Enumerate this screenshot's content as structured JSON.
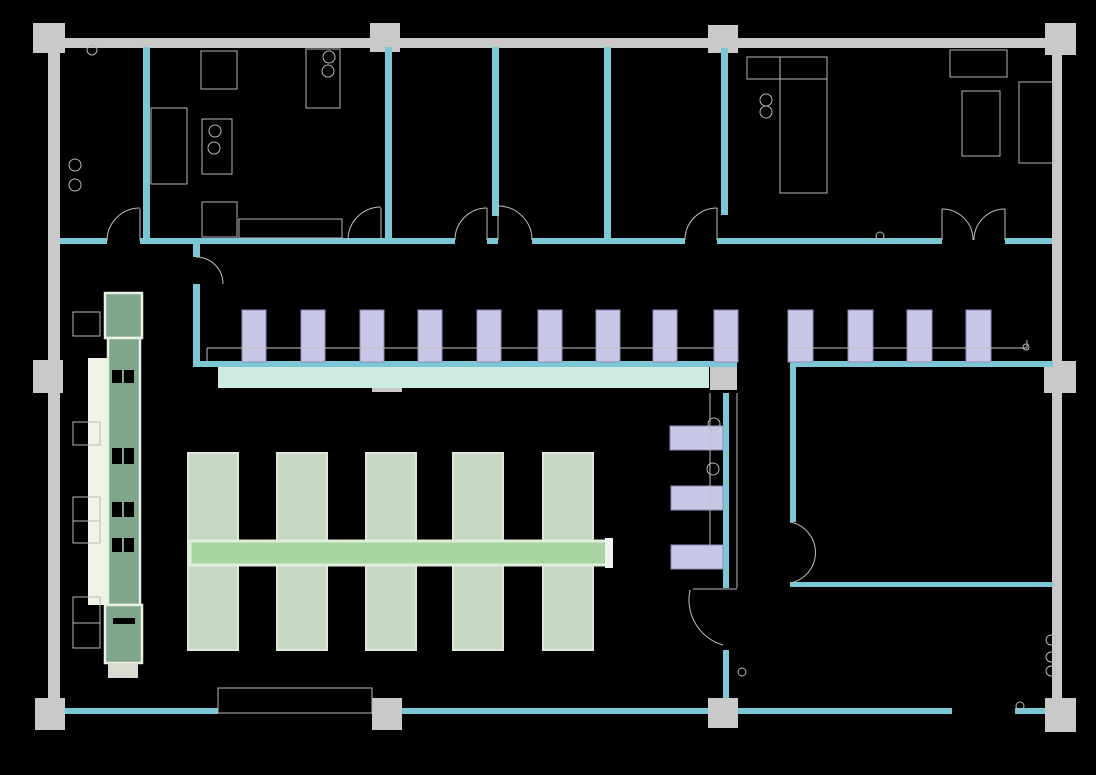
{
  "meta": {
    "description": "CAD floor plan of a cafeteria / canteen on black background",
    "canvas": {
      "width": 1096,
      "height": 775,
      "background": "#000000"
    }
  },
  "palette": {
    "structure_gray": "#c9c9c9",
    "wall_teal": "#7cc7d6",
    "counter_mint": "#cdebdf",
    "chair_lavender": "#c9c7e8",
    "chair_border": "#8f8db8",
    "table_sage": "#c6d8c2",
    "table_border": "#dfe9da",
    "bar_green": "#a8d5a2",
    "bar_border": "#e0efdb",
    "bar_cap": "#eef5ec",
    "buffet_green": "#7fa68b",
    "buffet_border": "#e9efe3",
    "buffet_strip": "#eef3e6",
    "buffet_cap": "#d9dad2",
    "outline_gray": "#b9b9b9",
    "line_gray": "#c0c0c0",
    "slot_black": "#000000"
  },
  "plan": {
    "layers": [
      {
        "name": "gray-structure",
        "kind": "rect",
        "fill": "#c9c9c9",
        "stroke": "none",
        "stroke_width": 0,
        "items": [
          [
            33,
            38,
            1042,
            10
          ],
          [
            48,
            47,
            12,
            662
          ],
          [
            1052,
            47,
            10,
            663
          ],
          [
            33,
            23,
            32,
            30
          ],
          [
            370,
            23,
            30,
            29
          ],
          [
            708,
            25,
            30,
            28
          ],
          [
            1045,
            23,
            31,
            32
          ],
          [
            33,
            360,
            30,
            33
          ],
          [
            372,
            368,
            30,
            24
          ],
          [
            710,
            365,
            27,
            25
          ],
          [
            1044,
            361,
            32,
            32
          ],
          [
            35,
            698,
            30,
            32
          ],
          [
            372,
            698,
            30,
            32
          ],
          [
            708,
            698,
            30,
            30
          ],
          [
            1045,
            698,
            31,
            34
          ]
        ]
      },
      {
        "name": "teal-wall",
        "kind": "rect",
        "fill": "#7cc7d6",
        "stroke": "none",
        "stroke_width": 0,
        "items": [
          [
            143,
            47,
            7,
            194
          ],
          [
            385,
            47,
            7,
            194
          ],
          [
            492,
            47,
            7,
            169
          ],
          [
            604,
            47,
            7,
            194
          ],
          [
            721,
            48,
            7,
            167
          ],
          [
            193,
            244,
            7,
            13
          ],
          [
            193,
            284,
            7,
            81
          ],
          [
            723,
            393,
            6,
            195
          ],
          [
            723,
            650,
            6,
            48
          ],
          [
            790,
            367,
            6,
            155
          ],
          [
            60,
            238,
            47,
            6
          ],
          [
            140,
            238,
            315,
            6
          ],
          [
            487,
            238,
            11,
            6
          ],
          [
            532,
            238,
            153,
            6
          ],
          [
            717,
            238,
            225,
            6
          ],
          [
            1005,
            238,
            47,
            6
          ],
          [
            193,
            361,
            544,
            6
          ],
          [
            790,
            361,
            263,
            6
          ],
          [
            790,
            582,
            263,
            5
          ],
          [
            65,
            708,
            153,
            6
          ],
          [
            402,
            708,
            306,
            6
          ],
          [
            738,
            708,
            214,
            6
          ],
          [
            1015,
            708,
            30,
            6
          ]
        ]
      },
      {
        "name": "service-counter",
        "kind": "rect",
        "fill": "#cdebdf",
        "stroke": "none",
        "stroke_width": 0,
        "items": [
          [
            218,
            367,
            491,
            21
          ]
        ]
      },
      {
        "name": "buffet-strip",
        "kind": "rect",
        "fill": "#eef3e6",
        "stroke": "none",
        "stroke_width": 0,
        "items": [
          [
            88,
            358,
            19,
            247
          ]
        ]
      },
      {
        "name": "buffet-block",
        "kind": "rect",
        "fill": "#7fa68b",
        "stroke": "#e9efe3",
        "stroke_width": 2.5,
        "items": [
          [
            105,
            293,
            37,
            45
          ],
          [
            108,
            338,
            32,
            267
          ],
          [
            105,
            605,
            37,
            58
          ]
        ]
      },
      {
        "name": "buffet-slot",
        "kind": "rect",
        "fill": "#000000",
        "stroke": "none",
        "stroke_width": 0,
        "items": [
          [
            112,
            370,
            10,
            13
          ],
          [
            124,
            370,
            10,
            13
          ],
          [
            112,
            448,
            10,
            16
          ],
          [
            124,
            448,
            10,
            16
          ],
          [
            112,
            502,
            10,
            15
          ],
          [
            124,
            502,
            10,
            15
          ],
          [
            112,
            538,
            10,
            14
          ],
          [
            124,
            538,
            10,
            14
          ],
          [
            113,
            618,
            22,
            6
          ]
        ]
      },
      {
        "name": "buffet-cap",
        "kind": "rect",
        "fill": "#d9dad2",
        "stroke": "none",
        "stroke_width": 0,
        "items": [
          [
            108,
            663,
            30,
            15
          ]
        ]
      },
      {
        "name": "bar-stool",
        "kind": "rect",
        "fill": "#c9c7e8",
        "stroke": "#8f8db8",
        "stroke_width": 1,
        "items": [
          [
            242,
            310,
            24,
            52
          ],
          [
            301,
            310,
            24,
            52
          ],
          [
            360,
            310,
            24,
            52
          ],
          [
            418,
            310,
            24,
            52
          ],
          [
            477,
            310,
            24,
            52
          ],
          [
            538,
            310,
            24,
            52
          ],
          [
            596,
            310,
            24,
            52
          ],
          [
            653,
            310,
            24,
            52
          ],
          [
            714,
            310,
            24,
            52
          ],
          [
            788,
            310,
            25,
            52
          ],
          [
            848,
            310,
            25,
            52
          ],
          [
            907,
            310,
            25,
            52
          ],
          [
            966,
            310,
            25,
            52
          ],
          [
            670,
            426,
            53,
            24
          ],
          [
            671,
            486,
            52,
            24
          ],
          [
            671,
            545,
            52,
            24
          ]
        ]
      },
      {
        "name": "dining-table",
        "kind": "rect",
        "fill": "#c6d8c2",
        "stroke": "#dfe9da",
        "stroke_width": 2,
        "items": [
          [
            188,
            453,
            50,
            197
          ],
          [
            277,
            453,
            50,
            197
          ],
          [
            366,
            453,
            50,
            197
          ],
          [
            453,
            453,
            50,
            197
          ],
          [
            543,
            453,
            50,
            197
          ]
        ]
      },
      {
        "name": "serving-bar",
        "kind": "rect",
        "fill": "#a8d5a2",
        "stroke": "#e0efdb",
        "stroke_width": 3,
        "items": [
          [
            190,
            541,
            420,
            24
          ]
        ]
      },
      {
        "name": "serving-bar-cap",
        "kind": "rect",
        "fill": "#eef5ec",
        "stroke": "none",
        "stroke_width": 0,
        "items": [
          [
            605,
            538,
            8,
            30
          ]
        ]
      },
      {
        "name": "fixture-outline",
        "kind": "rect",
        "fill": "none",
        "stroke": "#b9b9b9",
        "stroke_width": 1,
        "items": [
          [
            73,
            312,
            27,
            24
          ],
          [
            73,
            422,
            27,
            23
          ],
          [
            73,
            497,
            27,
            24
          ],
          [
            73,
            521,
            27,
            22
          ],
          [
            73,
            597,
            27,
            26
          ],
          [
            73,
            623,
            27,
            25
          ],
          [
            201,
            51,
            36,
            38
          ],
          [
            151,
            108,
            36,
            76
          ],
          [
            202,
            119,
            30,
            55
          ],
          [
            202,
            202,
            35,
            35
          ],
          [
            239,
            219,
            103,
            19
          ],
          [
            306,
            49,
            34,
            59
          ],
          [
            747,
            57,
            80,
            22
          ],
          [
            780,
            79,
            47,
            114
          ],
          [
            950,
            50,
            57,
            27
          ],
          [
            962,
            91,
            38,
            65
          ],
          [
            1019,
            82,
            34,
            81
          ],
          [
            218,
            688,
            154,
            25
          ]
        ]
      },
      {
        "name": "detail-line",
        "kind": "line",
        "fill": "none",
        "stroke": "#c0c0c0",
        "stroke_width": 1,
        "items": [
          [
            207,
            348,
            737,
            348
          ],
          [
            207,
            348,
            207,
            361
          ],
          [
            790,
            348,
            1027,
            348
          ],
          [
            1027,
            340,
            1027,
            348
          ],
          [
            710,
            393,
            710,
            545
          ],
          [
            737,
            393,
            737,
            588
          ],
          [
            780,
            57,
            780,
            79
          ],
          [
            693,
            589,
            737,
            589
          ],
          [
            942,
            240,
            942,
            209
          ],
          [
            1005,
            240,
            1005,
            209
          ],
          [
            140,
            241,
            140,
            209
          ],
          [
            381,
            240,
            381,
            208
          ],
          [
            487,
            240,
            487,
            208
          ],
          [
            498,
            240,
            498,
            206
          ],
          [
            717,
            240,
            717,
            208
          ]
        ]
      },
      {
        "name": "door-arc",
        "kind": "path",
        "fill": "none",
        "stroke": "#c0c0c0",
        "stroke_width": 1,
        "items": [
          "M107,241 A33,33 0 0 1 140,208",
          "M348,240 A33,33 0 0 1 381,207",
          "M455,240 A32,32 0 0 1 487,208",
          "M532,240 A34,34 0 0 0 498,206",
          "M685,240 A32,32 0 0 1 717,208",
          "M942,209 A31,31 0 0 1 973,240",
          "M1005,209 A31,31 0 0 0 974,240",
          "M196,257 A27,27 0 0 1 223,284",
          "M690,590 A47,47 0 0 0 723,645",
          "M790,522 A31,31 0 0 1 790,583"
        ]
      },
      {
        "name": "detail-circle",
        "kind": "circle",
        "fill": "none",
        "stroke": "#b9b9b9",
        "stroke_width": 1,
        "items": [
          [
            92,
            50,
            5
          ],
          [
            75,
            165,
            6
          ],
          [
            75,
            185,
            6
          ],
          [
            215,
            131,
            6
          ],
          [
            214,
            148,
            6
          ],
          [
            329,
            57,
            6
          ],
          [
            328,
            71,
            6
          ],
          [
            766,
            100,
            6
          ],
          [
            766,
            112,
            6
          ],
          [
            880,
            236,
            4
          ],
          [
            1026,
            347,
            3
          ],
          [
            714,
            424,
            6
          ],
          [
            713,
            469,
            6
          ],
          [
            742,
            672,
            4
          ],
          [
            1051,
            640,
            5
          ],
          [
            1051,
            657,
            5
          ],
          [
            1051,
            671,
            5
          ],
          [
            1020,
            706,
            4
          ]
        ]
      }
    ]
  }
}
